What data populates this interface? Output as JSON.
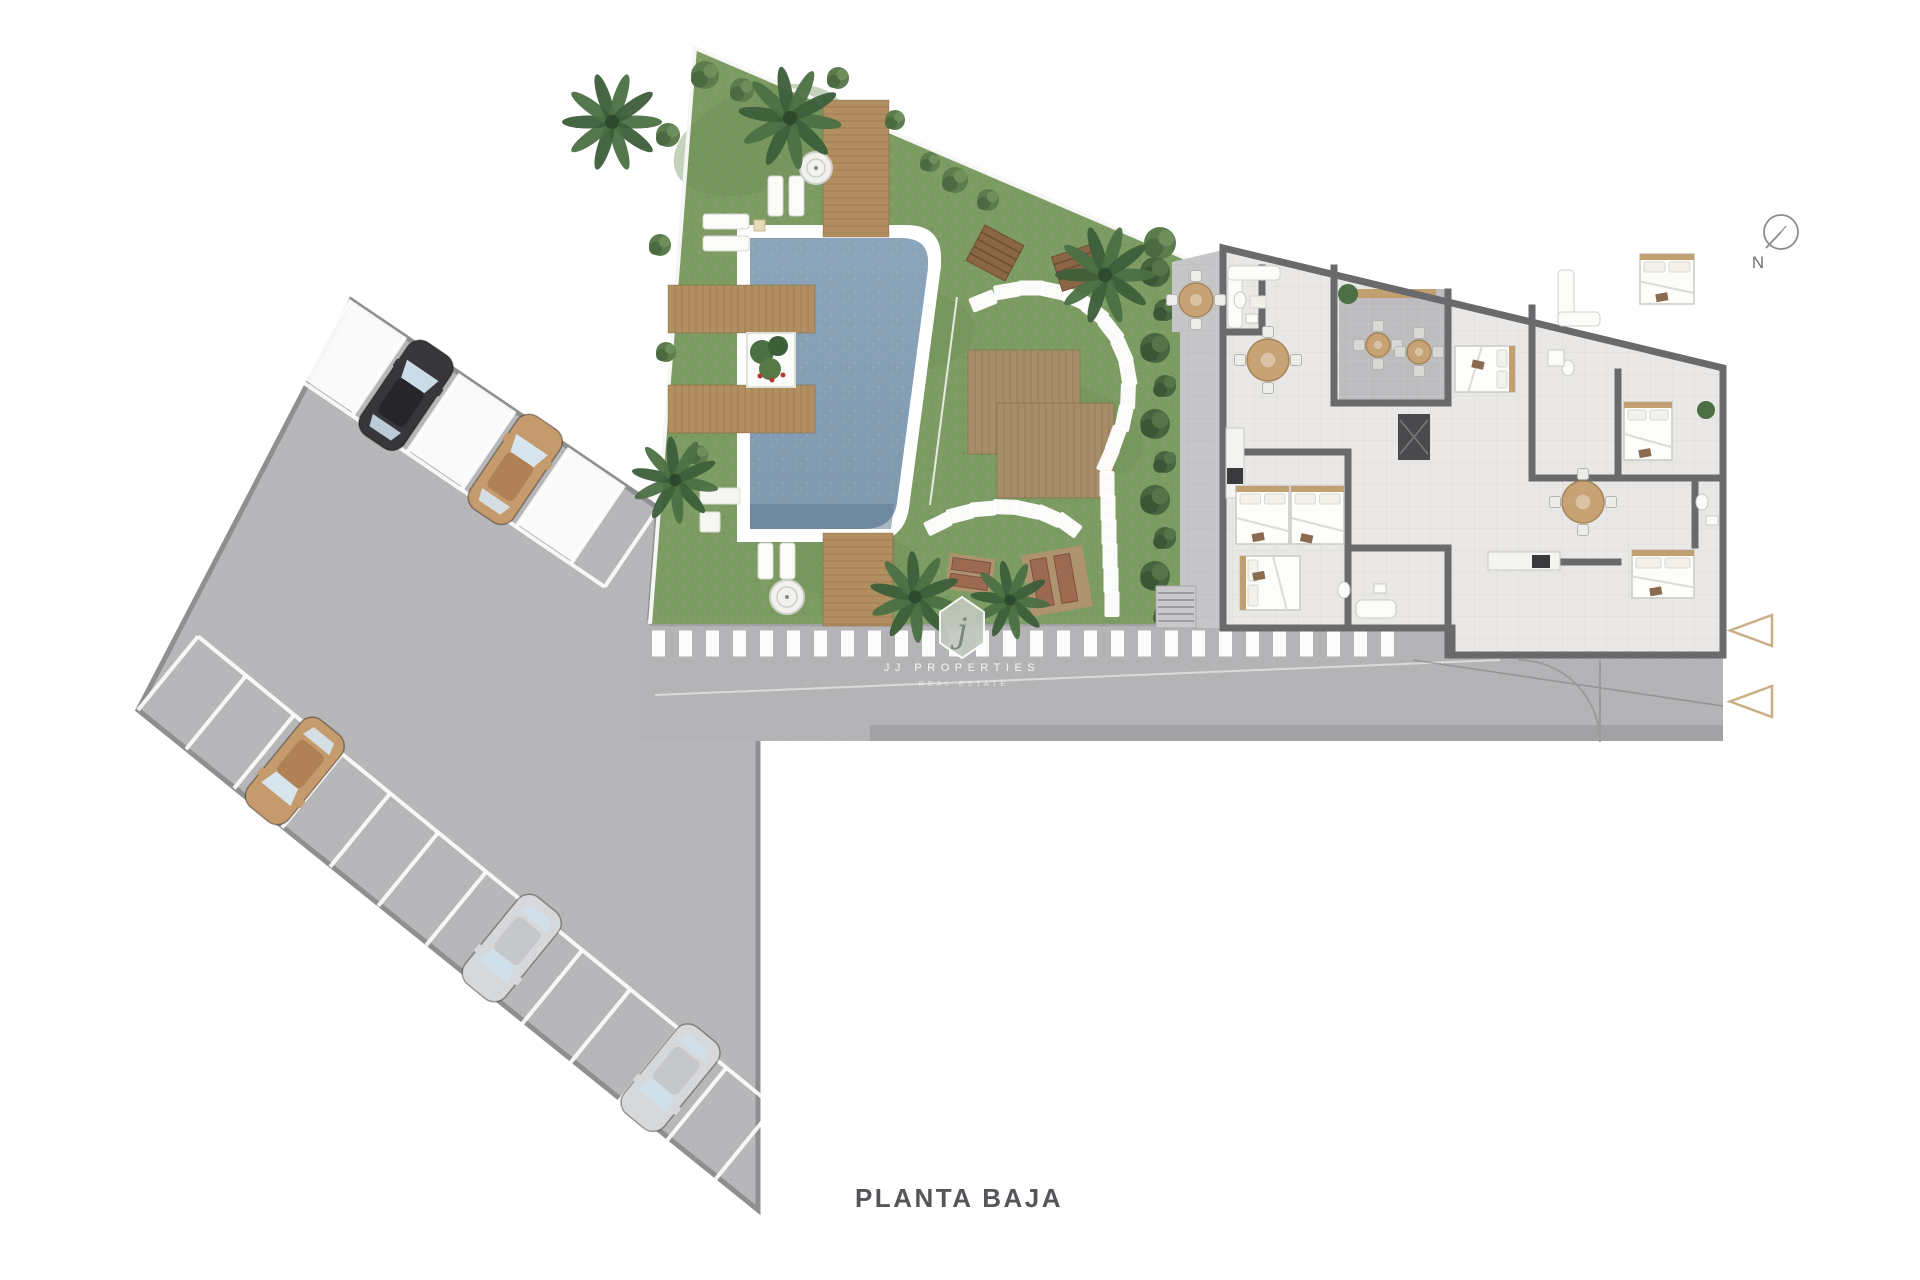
{
  "plan": {
    "title": "PLANTA BAJA",
    "compass": {
      "label": "N"
    },
    "watermark": {
      "brand": "JJ PROPERTIES",
      "tagline": "REAL ESTATE",
      "monogram": "j"
    },
    "entrance_arrows": {
      "count": 2,
      "color": "#c9af83"
    },
    "colors": {
      "background": "#ffffff",
      "parking_asphalt": "#b7b7b9",
      "road_asphalt": "#b4b4b6",
      "curb": "#8f8f91",
      "stripe_white": "#ffffff",
      "grass": "#7d9c63",
      "grass_shade": "#6f8f58",
      "pool_water_top": "#8ba5bb",
      "pool_water_bottom": "#7e98ae",
      "pool_rim": "#ffffff",
      "deck_wood": "#b28f60",
      "platform_wood": "#a88d6a",
      "building_wall": "#6a6a6d",
      "building_floor": "#e9e8e6",
      "terrace_floor": "#bdbdbf",
      "courtyard_floor": "#c6c6c8",
      "hedge_green": "#47653f",
      "palm_green": "#3c5e39",
      "palm_green_light": "#4c7044",
      "bush_green": "#5d7c4e",
      "planter_flower": "#b33a30",
      "red_lounger": "#9c6a50",
      "title_text": "#55565a",
      "compass_stroke": "#8b8b8d",
      "watermark_badge": "#c2c9be",
      "watermark_monogram": "#7c8a7a"
    },
    "cars": [
      {
        "id": "car-1",
        "color_name": "black",
        "body": "#37373a",
        "roof": "#26262a",
        "glass": "#c9dce8"
      },
      {
        "id": "car-2",
        "color_name": "tan",
        "body": "#c59a6d",
        "roof": "#b08155",
        "glass": "#d6e5ee"
      },
      {
        "id": "car-3",
        "color_name": "tan",
        "body": "#c59a6d",
        "roof": "#b08155",
        "glass": "#d6e5ee"
      },
      {
        "id": "car-4",
        "color_name": "silver",
        "body": "#d7d8da",
        "roof": "#c6c7c9",
        "glass": "#cfe0ea"
      },
      {
        "id": "car-5",
        "color_name": "silver",
        "body": "#d7d8da",
        "roof": "#c6c7c9",
        "glass": "#cfe0ea"
      }
    ]
  }
}
